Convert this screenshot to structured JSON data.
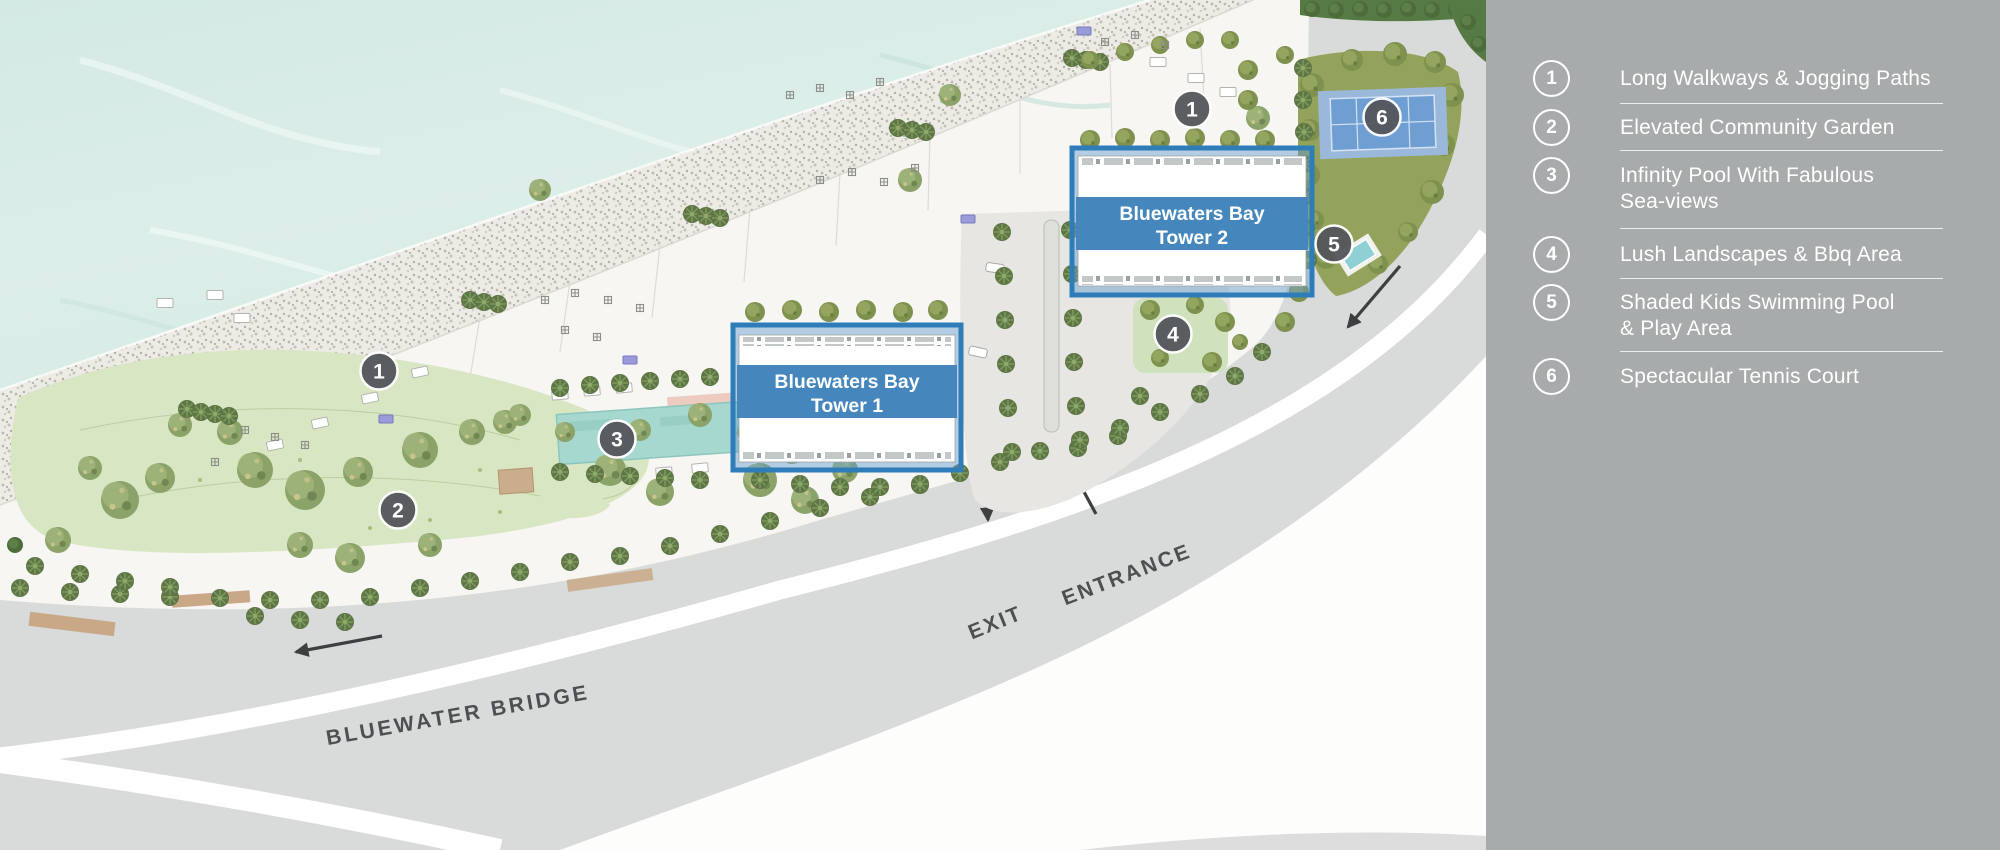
{
  "legend": {
    "items": [
      {
        "num": "1",
        "line1": "Long Walkways & Jogging Paths",
        "line2": ""
      },
      {
        "num": "2",
        "line1": "Elevated Community Garden",
        "line2": ""
      },
      {
        "num": "3",
        "line1": "Infinity Pool With Fabulous",
        "line2": "Sea-views"
      },
      {
        "num": "4",
        "line1": "Lush Landscapes & Bbq Area",
        "line2": ""
      },
      {
        "num": "5",
        "line1": "Shaded Kids Swimming Pool",
        "line2": "& Play Area"
      },
      {
        "num": "6",
        "line1": "Spectacular Tennis Court",
        "line2": ""
      }
    ]
  },
  "map": {
    "towers": {
      "tower1": {
        "line1": "Bluewaters Bay",
        "line2": "Tower 1"
      },
      "tower2": {
        "line1": "Bluewaters Bay",
        "line2": "Tower 2"
      }
    },
    "road": {
      "name": "BLUEWATER BRIDGE",
      "exit": "EXIT",
      "entrance": "ENTRANCE"
    },
    "markers": {
      "m1": "1",
      "m2": "2",
      "m3": "3",
      "m4": "4",
      "m5": "5",
      "m6": "6"
    }
  },
  "colors": {
    "sidebar_bg": "#a7abab",
    "water": "#d7ebe6",
    "lawn": "#d9e6c3",
    "road": "#d9dada",
    "marker_bg": "#54565b",
    "tower_band": "#4587bd",
    "tower_border": "#2e7cb8",
    "tennis_court": "#6f9ed2",
    "road_text": "#4e4f52"
  }
}
